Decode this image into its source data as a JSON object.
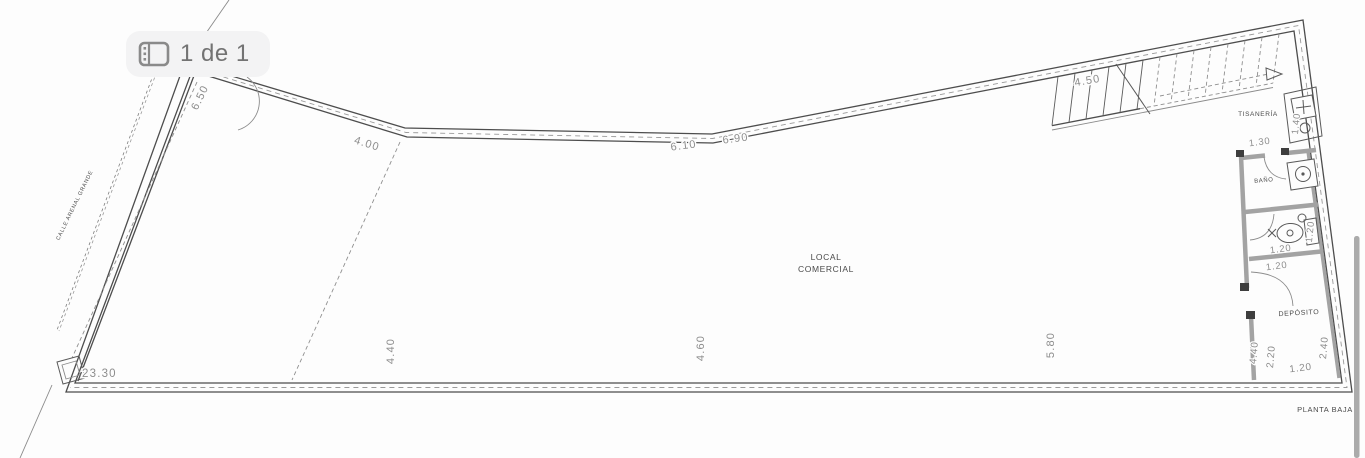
{
  "badge": {
    "icon": "gallery-icon",
    "label": "1 de 1"
  },
  "plan": {
    "street_label": "CALLE ARENAL GRANDE",
    "floor_label": "PLANTA BAJA",
    "rooms": {
      "local_line1": "LOCAL",
      "local_line2": "COMERCIAL",
      "tisaneria": "TISANERÍA",
      "bano": "BAÑO",
      "deposito": "DEPÓSITO"
    },
    "dimensions": {
      "left_wall": "6.50",
      "top_seg1": "4.00",
      "top_seg2": "6.10",
      "top_seg3": "6.90",
      "stairs": "4.50",
      "tisaneria_width": "1.30",
      "tisaneria_depth": "1.40",
      "bath_width": "1.20",
      "bath_side": "1.20",
      "partition": "1.20",
      "bottom_total": "23.30",
      "bottom_1": "4.40",
      "bottom_2": "4.60",
      "bottom_3": "5.80",
      "deposito_depth": "4.40",
      "deposito_w1": "2.20",
      "deposito_w2": "1.20",
      "deposito_w3": "2.40"
    }
  },
  "colors": {
    "line": "#4d4d4d",
    "wall_gray": "#a3a3a3",
    "dim_text": "#8d8d8d",
    "label_text": "#4a4a4a",
    "badge_bg": "#f3f3f4",
    "badge_text": "#737373",
    "side_bar": "#ababab"
  }
}
